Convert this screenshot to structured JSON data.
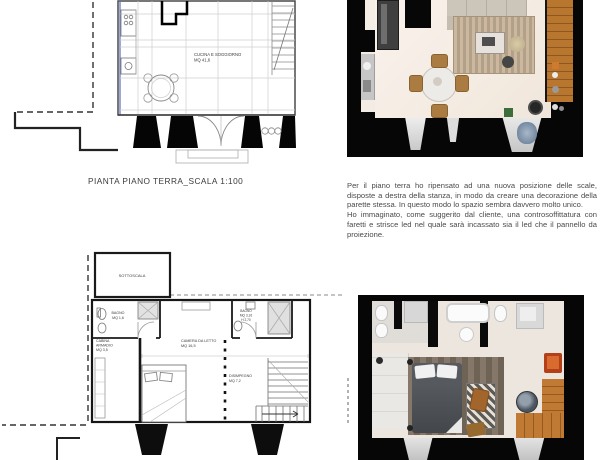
{
  "ground_floor": {
    "caption": "PIANTA PIANO TERRA_SCALA 1:100",
    "room_labels": {
      "cucina_line1": "CUCINA E SOGGIORNO",
      "cucina_line2": "MQ 41,6"
    }
  },
  "first_floor": {
    "room_labels": {
      "sottoscala": "SOTTOSCALA",
      "bagno_left_line1": "BAGNO",
      "bagno_left_line2": "MQ 1,6",
      "cabina_line1": "CABINA",
      "cabina_line2": "ARMADIO",
      "cabina_line3": "MQ 3,5",
      "camera_line1": "CAMERA DA LETTO",
      "camera_line2": "MQ 16,5",
      "bagno_right_line1": "BAGNO",
      "bagno_right_line2": "MQ 3,16",
      "bagno_right_line3": "H 2,70",
      "disimpegno_line1": "DISIMPEGNO",
      "disimpegno_line2": "MQ 7,2"
    }
  },
  "description": {
    "paragraph1": "Per il piano terra ho ripensato ad una nuova posizione delle scale, disposte a destra della stanza, in modo da creare una decorazione della parette stessa. In questo modo lo spazio sembra davvero molto unico.",
    "paragraph2": "Ho immaginato, come suggerito dal cliente, una controsoffittatura con faretti e strisce led nel quale sarà incassato sia il led che il pannello da proiezione."
  },
  "colors": {
    "wall_black": "#060606",
    "wood_stairs": "#b8762f",
    "rug_beige": "#c3b09a",
    "floor_cream": "#f3ece3",
    "bed_gray": "#4b4f53",
    "accent_orange": "#c14a1e",
    "plan_line": "#3a3a3a",
    "section_blue": "#5b6fb5"
  }
}
